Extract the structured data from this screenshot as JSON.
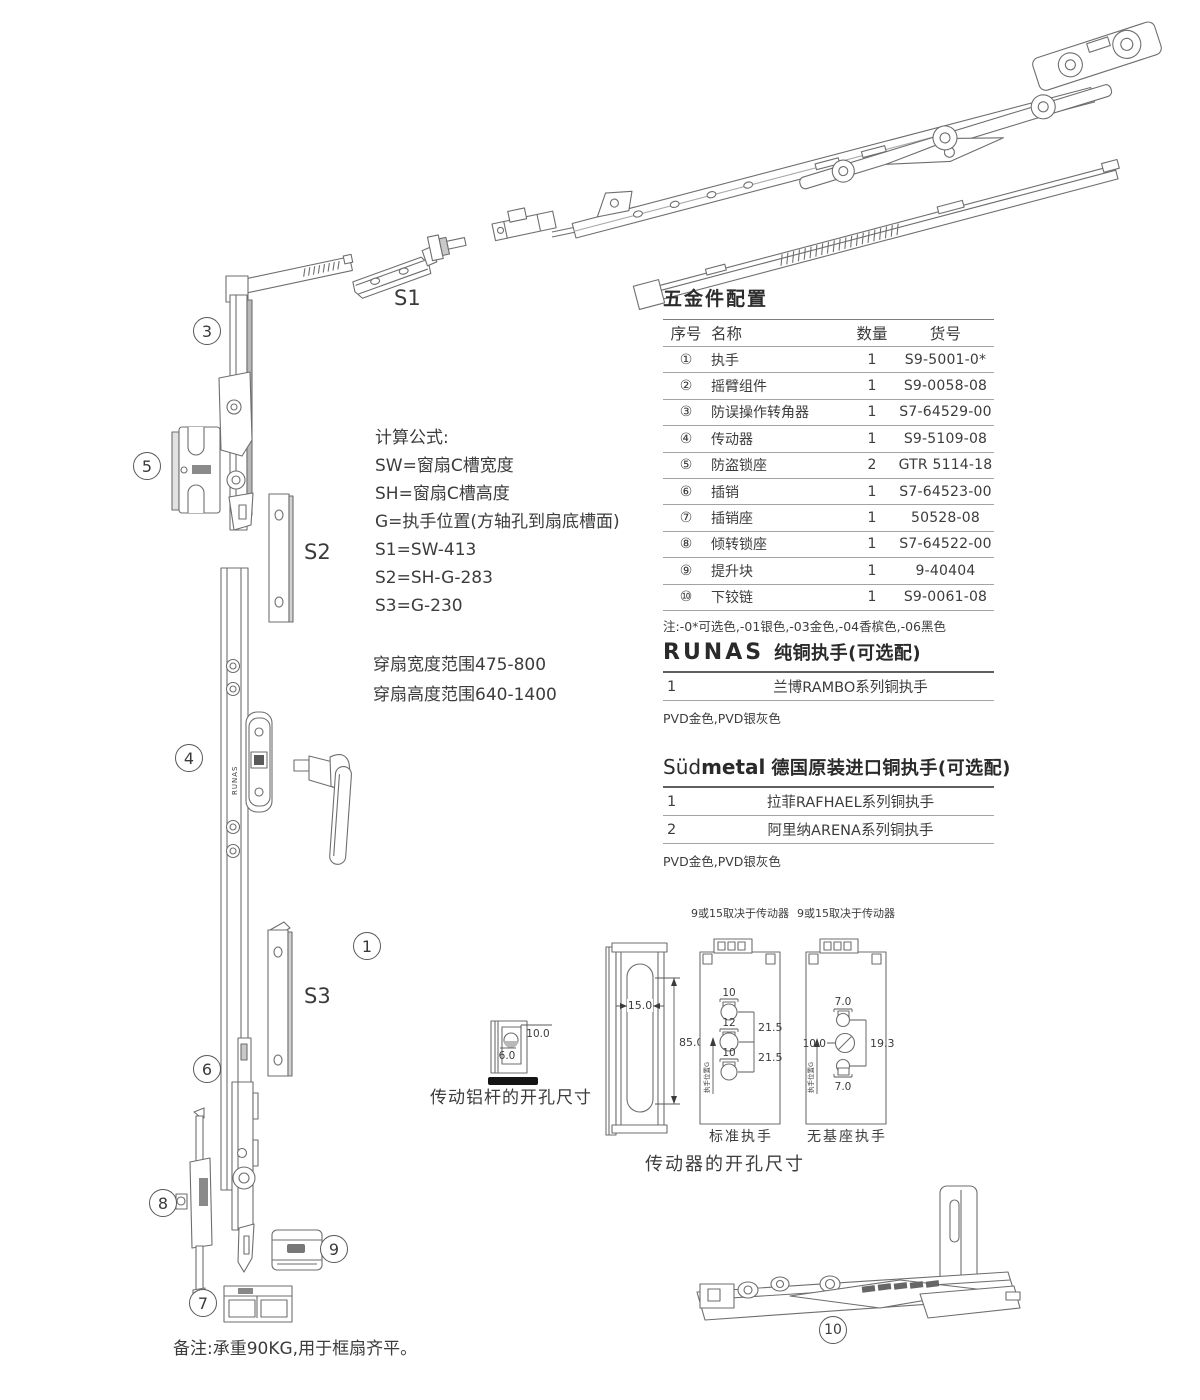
{
  "doc": {
    "bg": "#ffffff",
    "ink": "#6e6e6e",
    "text_color": "#3c3c3c"
  },
  "labels": {
    "n1": "1",
    "n3": "3",
    "n4": "4",
    "n5": "5",
    "n6": "6",
    "n7": "7",
    "n8": "8",
    "n9": "9",
    "n10": "10",
    "s1": "S1",
    "s2": "S2",
    "s3": "S3",
    "bar_marking": "RUNAS"
  },
  "formulas": {
    "title": "计算公式:",
    "lines": [
      "SW=窗扇C槽宽度",
      "SH=窗扇C槽高度",
      "G=执手位置(方轴孔到扇底槽面)",
      "S1=SW-413",
      "S2=SH-G-283",
      "S3=G-230"
    ]
  },
  "ranges": {
    "line1": "穿扇宽度范围475-800",
    "line2": "穿扇高度范围640-1400"
  },
  "hardware_table": {
    "title": "五金件配置",
    "headers": [
      "序号",
      "名称",
      "数量",
      "货号"
    ],
    "rows": [
      [
        "①",
        "执手",
        "1",
        "S9-5001-0*"
      ],
      [
        "②",
        "摇臂组件",
        "1",
        "S9-0058-08"
      ],
      [
        "③",
        "防误操作转角器",
        "1",
        "S7-64529-00"
      ],
      [
        "④",
        "传动器",
        "1",
        "S9-5109-08"
      ],
      [
        "⑤",
        "防盗锁座",
        "2",
        "GTR 5114-18"
      ],
      [
        "⑥",
        "插销",
        "1",
        "S7-64523-00"
      ],
      [
        "⑦",
        "插销座",
        "1",
        "50528-08"
      ],
      [
        "⑧",
        "倾转锁座",
        "1",
        "S7-64522-00"
      ],
      [
        "⑨",
        "提升块",
        "1",
        "9-40404"
      ],
      [
        "⑩",
        "下铰链",
        "1",
        "S9-0061-08"
      ]
    ],
    "note": "注:-0*可选色,-01银色,-03金色,-04香槟色,-06黑色"
  },
  "runas": {
    "brand": "RUNAS",
    "title": "纯铜执手(可选配)",
    "row_no": "1",
    "row_name": "兰博RAMBO系列铜执手",
    "finishes": "PVD金色,PVD银灰色"
  },
  "sudmetal": {
    "brand_light": "Süd",
    "brand_bold": "metal",
    "title": "德国原装进口铜执手(可选配)",
    "rows": [
      {
        "no": "1",
        "name": "拉菲RAFHAEL系列铜执手"
      },
      {
        "no": "2",
        "name": "阿里纳ARENA系列铜执手"
      }
    ],
    "finishes": "PVD金色,PVD银灰色"
  },
  "drawings": {
    "alu_rod": {
      "dim_top": "10.0",
      "dim_bottom": "6.0",
      "caption": "传动铝杆的开孔尺寸"
    },
    "profile": {
      "dim_width": "15.0",
      "dim_height": "85.0"
    },
    "standard": {
      "top_note": "9或15取决于传动器",
      "hole_top": "10",
      "hole_mid": "12",
      "hole_bottom": "10",
      "pitch_top": "21.5",
      "pitch_bottom": "21.5",
      "axis_label": "执手位置G",
      "caption": "标准执手"
    },
    "no_base": {
      "top_note": "9或15取决于传动器",
      "hole_top": "7.0",
      "hole_mid": "10.0",
      "pitch": "19.3",
      "hole_bottom": "7.0",
      "axis_label": "执手位置G",
      "caption": "无基座执手"
    },
    "caption": "传动器的开孔尺寸"
  },
  "footer": {
    "note": "备注:承重90KG,用于框扇齐平。"
  }
}
